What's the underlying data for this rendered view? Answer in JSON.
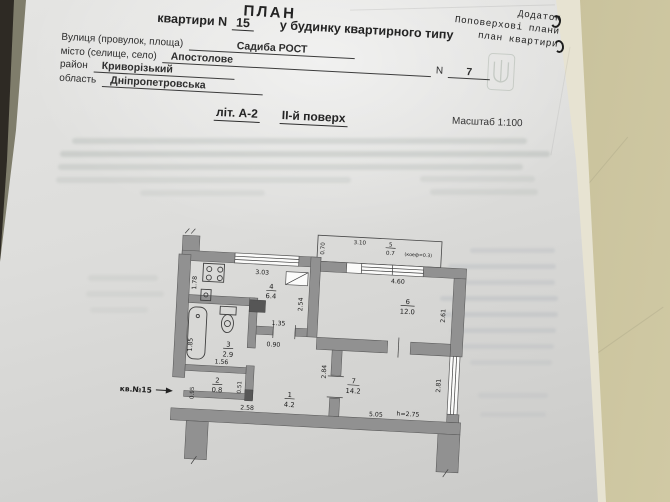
{
  "corner_note": {
    "line1": "Додаток",
    "line2": "Поповерхові плани",
    "line3": "план квартири"
  },
  "header": {
    "title": "ПЛАН",
    "line2_pre": "квартири N",
    "apt_no": "15",
    "line2_post": "у будинку квартирного типу",
    "field1_label": "Вулиця (провулок, площа)",
    "field1_value": "Садиба РОСТ",
    "field2_label": "місто (селище, село)",
    "field2_value": "Апостолове",
    "field2_n_label": "N",
    "field2_n_value": "7",
    "field3_label": "район",
    "field3_value": "Криворізький",
    "field4_label": "область",
    "field4_value": "Дніпропетровська",
    "lit": "літ. А-2",
    "floor": "ІІ-й поверх",
    "scale": "Масштаб 1:100"
  },
  "plan": {
    "apt_label": "кв.№15",
    "ceiling_height": "h=2.75",
    "rooms": {
      "r1": {
        "num": "1",
        "area": "4.2"
      },
      "r2": {
        "num": "2",
        "area": "0.8"
      },
      "r3": {
        "num": "3",
        "area": "2.9"
      },
      "r4": {
        "num": "4",
        "area": "6.4"
      },
      "r5": {
        "num": "5",
        "area": "0.7"
      },
      "r6": {
        "num": "6",
        "area": "12.0"
      },
      "r7": {
        "num": "7",
        "area": "14.2"
      }
    },
    "dims": {
      "kitchen_top": "3.03",
      "kitchen_left": "1.78",
      "kitchen_right": "2.54",
      "room6_top": "4.60",
      "room6_right": "2.61",
      "balcony_top": "3.10",
      "balcony_left": "0.70",
      "balcony_coef": "(коеф=0.3)",
      "bath_top": "1.35",
      "bath_door": "0.90",
      "bath_left": "1.85",
      "bath_bottom": "1.56",
      "closet_right": "0.51",
      "hall_wall": "2.84",
      "hall_bottom": "2.58",
      "entry": "0.95",
      "room7_bottom": "5.05",
      "room7_right": "2.81"
    }
  },
  "colors": {
    "wall_background": "#cfc8a3",
    "paper": "#dcdcda",
    "plan_wall": "#919191",
    "dark_edge": "#2e2a24",
    "olive_edge": "#7f7d6b"
  }
}
